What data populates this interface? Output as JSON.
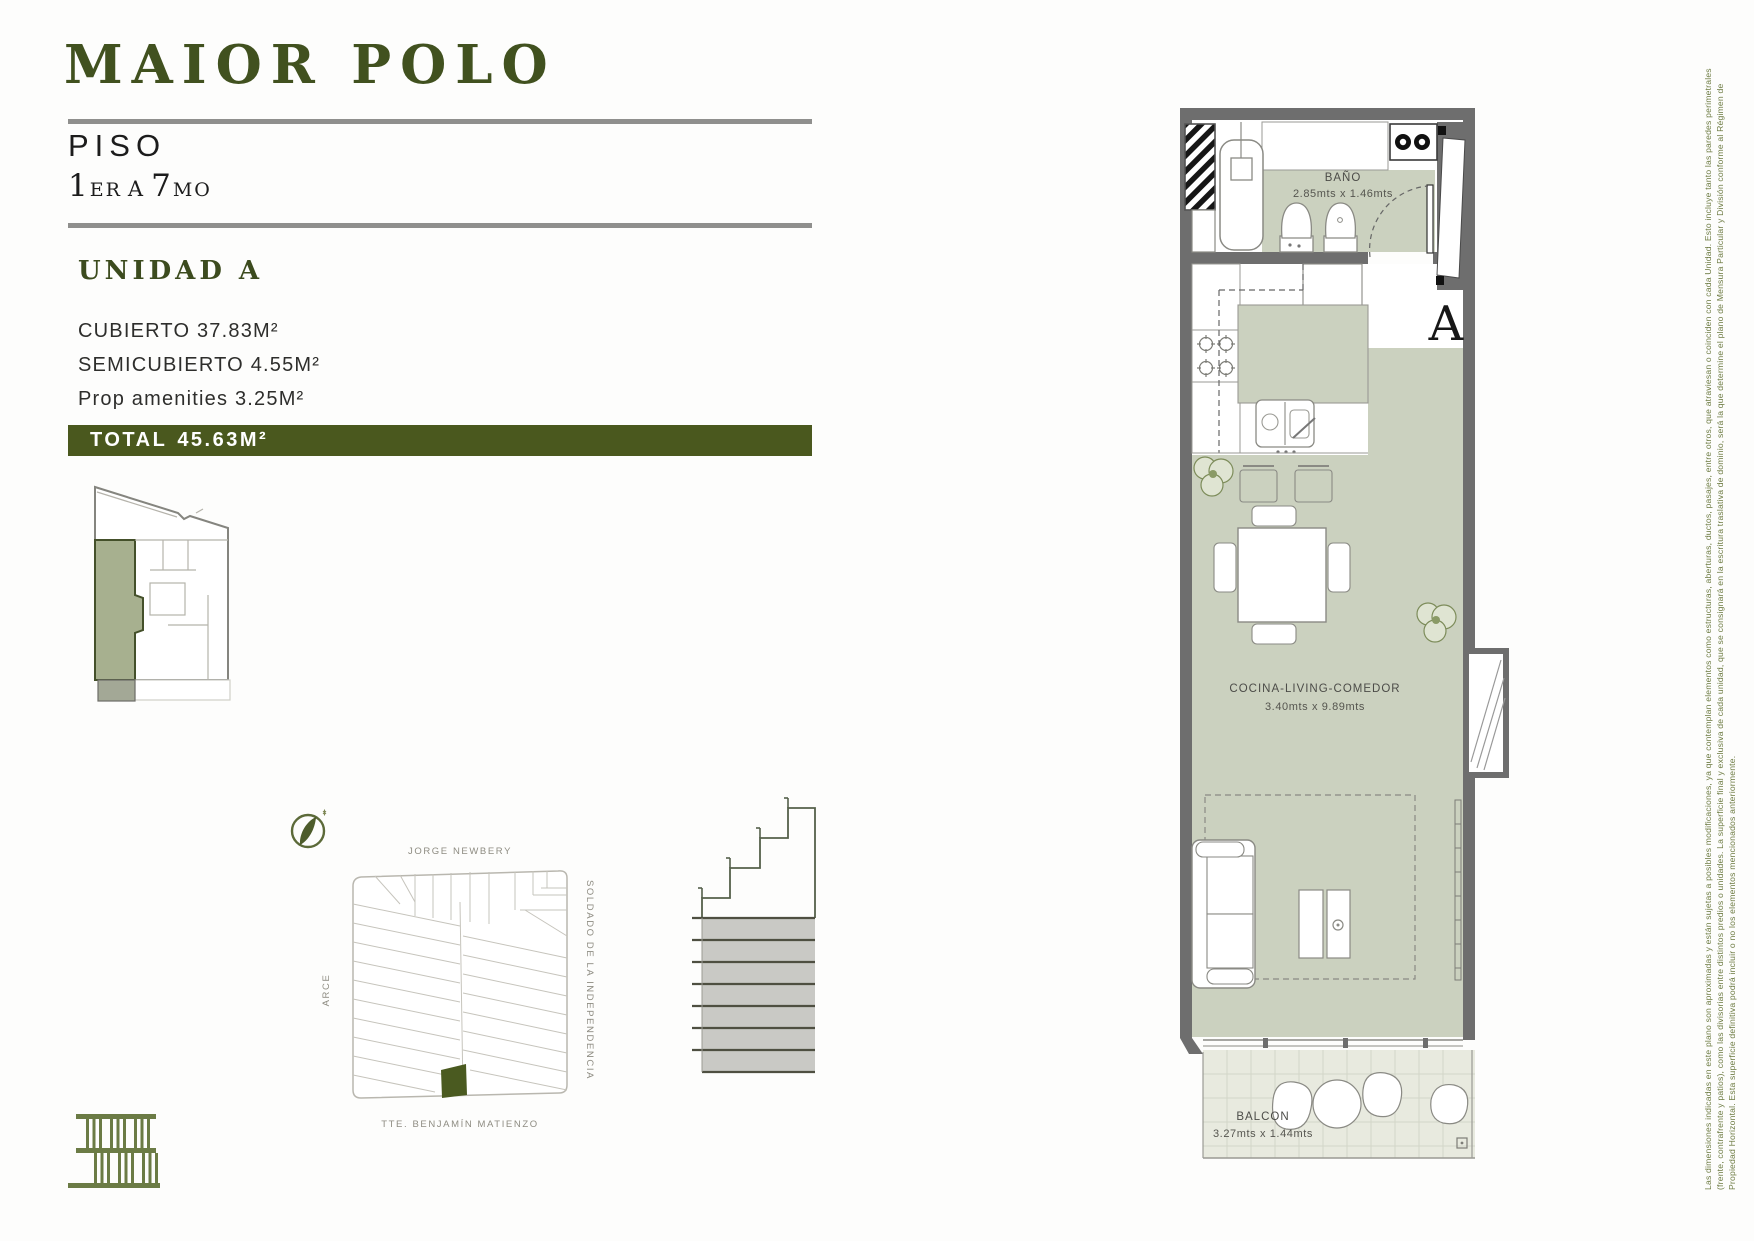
{
  "header": {
    "title": "MAIOR POLO",
    "floor_label": "PISO",
    "floor_parts": {
      "n1": "1",
      "s1": "ER",
      "conj": "A",
      "n2": "7",
      "s2": "MO"
    }
  },
  "unit": {
    "name": "UNIDAD A",
    "areas": [
      {
        "label": "CUBIERTO",
        "value": "37.83M²"
      },
      {
        "label": "SEMICUBIERTO",
        "value": "4.55M²"
      },
      {
        "label": "Prop amenities",
        "value": "3.25M²"
      }
    ],
    "total_label": "TOTAL",
    "total_value": "45.63M²"
  },
  "map": {
    "streets": {
      "top": "JORGE NEWBERY",
      "left": "ARCE",
      "right": "SOLDADO DE LA INDEPENDENCIA",
      "bottom": "TTE. BENJAMÍN MATIENZO"
    }
  },
  "plan": {
    "unit_letter": "A",
    "rooms": [
      {
        "name": "BAÑO",
        "dims": "2.85mts x 1.46mts"
      },
      {
        "name": "COCINA-LIVING-COMEDOR",
        "dims": "3.40mts x 9.89mts"
      },
      {
        "name": "BALCON",
        "dims": "3.27mts x 1.44mts"
      }
    ]
  },
  "colors": {
    "brand_green": "#41511f",
    "banner_green": "#4a581e",
    "floor_sage": "#cbd1bf",
    "wall_gray": "#6e6e6e",
    "map_parcel_green": "#4a5a20",
    "logo_olive": "#6b7b45"
  },
  "disclaimer": "Las dimensiones indicadas en este plano son aproximadas y están sujetas a posibles modificaciones, ya que contemplan elementos como estructuras, aberturas, ductos, pasajes, entre otros, que atraviesan o coinciden con cada Unidad. Esto incluye tanto las paredes perimetrales (frente, contrafrente y patios), como las divisorias entre distintos predios o unidades. La superficie final y exclusiva de cada unidad, que se consignará en la escritura traslativa de dominio, será la que determine el plano de Mensura Particular y División conforme al Régimen de Propiedad Horizontal. Esta superficie definitiva podrá incluir o no los elementos mencionados anteriormente."
}
